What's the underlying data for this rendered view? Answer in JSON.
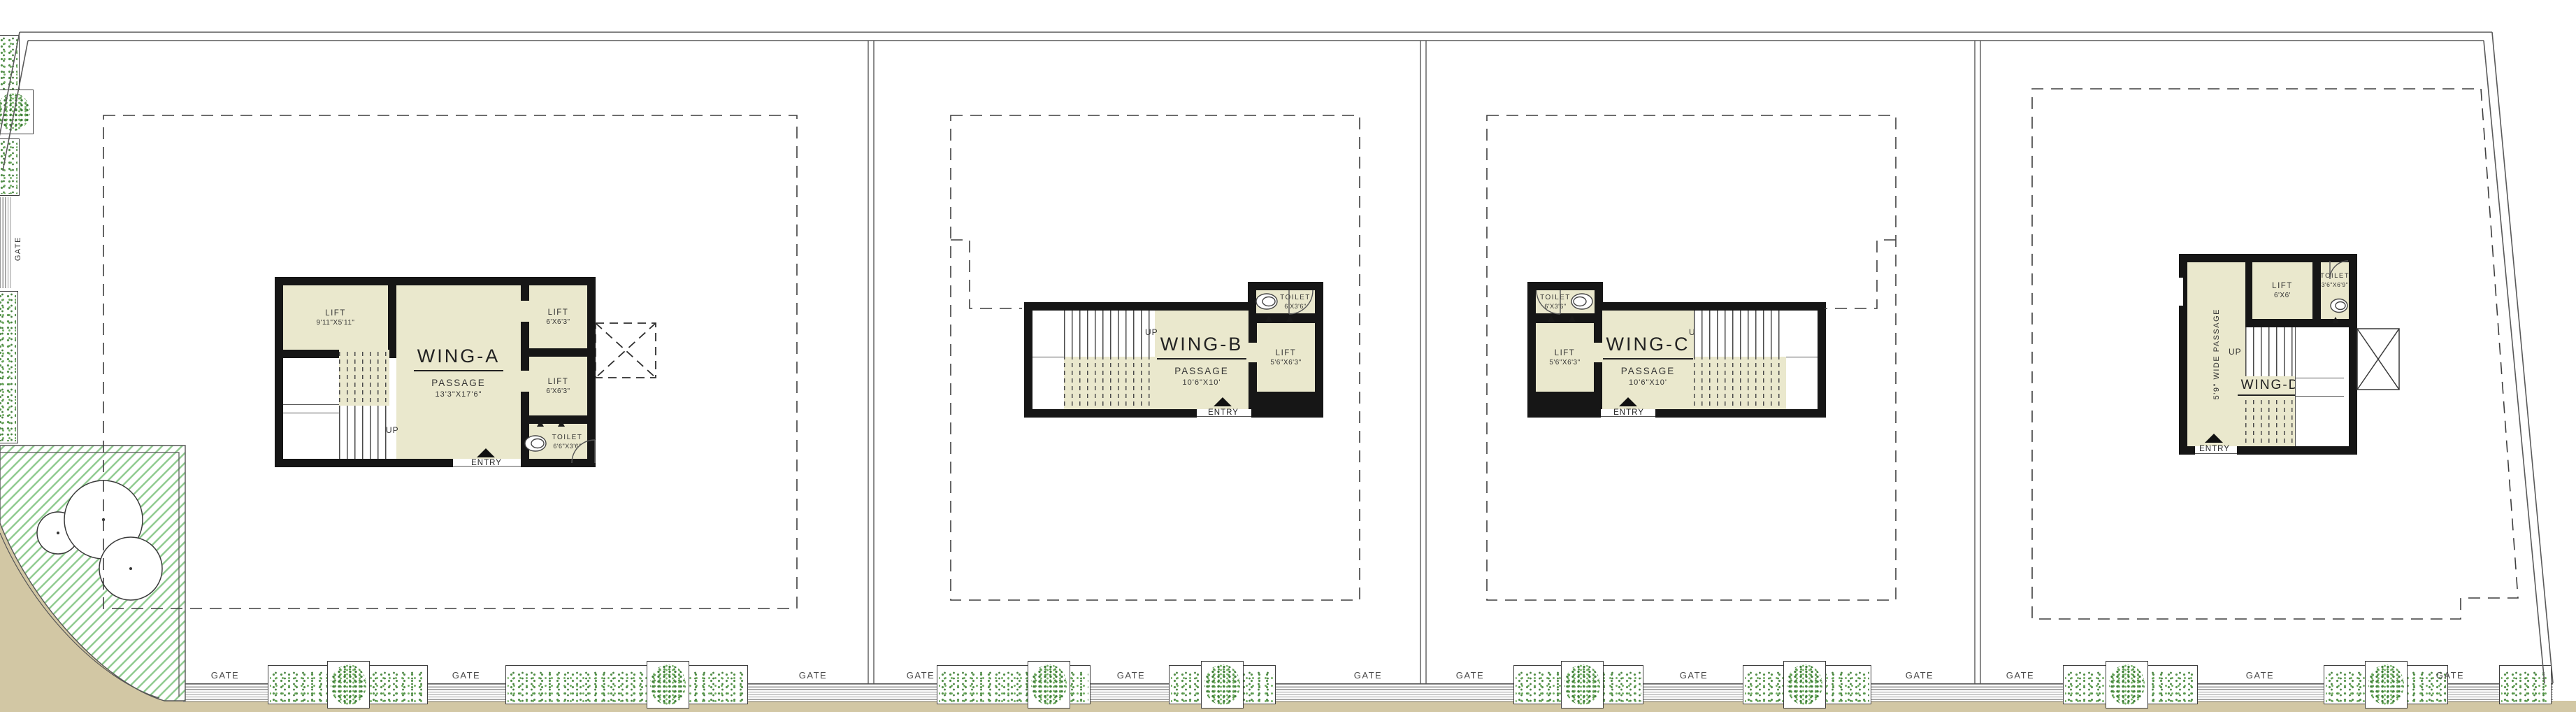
{
  "labels": {
    "gate": "GATE",
    "up": "UP",
    "entry": "ENTRY"
  },
  "wings": {
    "a": {
      "title": "WING-A",
      "passage_name": "PASSAGE",
      "passage_dims": "13'3\"X17'6\"",
      "lift_main_name": "LIFT",
      "lift_main_dims": "9'11\"X5'11\"",
      "lift_top_name": "LIFT",
      "lift_top_dims": "6'X6'3\"",
      "lift_mid_name": "LIFT",
      "lift_mid_dims": "6'X6'3\"",
      "toilet_name": "TOILET",
      "toilet_dims": "6'6\"X3'6\""
    },
    "b": {
      "title": "WING-B",
      "passage_name": "PASSAGE",
      "passage_dims": "10'6\"X10'",
      "toilet_name": "TOILET",
      "toilet_dims": "6'X3'6\"",
      "lift_name": "LIFT",
      "lift_dims": "5'6\"X6'3\""
    },
    "c": {
      "title": "WING-C",
      "passage_name": "PASSAGE",
      "passage_dims": "10'6\"X10'",
      "toilet_name": "TOILET",
      "toilet_dims": "6'X3'6\"",
      "lift_name": "LIFT",
      "lift_dims": "5'6\"X6'3\""
    },
    "d": {
      "title": "WING-D",
      "passage_label": "5'9\" WIDE PASSAGE",
      "lift_name": "LIFT",
      "lift_dims": "6'X6'",
      "toilet_name": "TOILET",
      "toilet_dims": "3'6\"X6'9\""
    }
  },
  "colors": {
    "room_fill": "#eae8cd",
    "wall": "#161616",
    "road": "#d2c7a4",
    "hedge_green": "#54914a",
    "hatch_green": "#8cc98c",
    "line_gray": "#555555"
  }
}
